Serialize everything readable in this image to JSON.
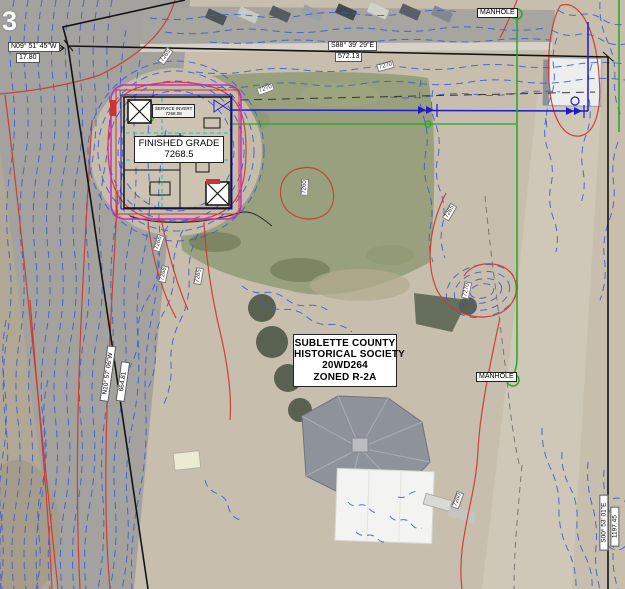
{
  "pavement_marking": "3",
  "survey": {
    "nw_bearing": "N09° 51' 45\"W",
    "nw_distance": "17.80",
    "north_bearing": "S88° 39' 29\"E",
    "north_distance": "572.13",
    "west_bearing": "N10° 57' 06\"W",
    "west_distance": "664.81",
    "east_bearing": "S00° 53' 01\"E",
    "east_distance": "1197.45"
  },
  "labels": {
    "manhole_top": "MANHOLE",
    "manhole_east": "MANHOLE",
    "finished_grade": {
      "line1": "FINISHED GRADE",
      "line2": "7268.5"
    },
    "service_invert": {
      "line1": "SERVICE INVERT",
      "line2": "7268.08"
    },
    "parcel": {
      "line1": "SUBLETTE COUNTY",
      "line2": "HISTORICAL SOCIETY",
      "line3": "20WD264",
      "line4": "ZONED R-2A"
    }
  },
  "contour_labels": [
    {
      "text": "7265",
      "x": 168,
      "y": 56,
      "rot": -55
    },
    {
      "text": "7270",
      "x": 268,
      "y": 89,
      "rot": -20
    },
    {
      "text": "7270",
      "x": 388,
      "y": 66,
      "rot": -15
    },
    {
      "text": "7266",
      "x": 161,
      "y": 243,
      "rot": -72
    },
    {
      "text": "7268",
      "x": 166,
      "y": 274,
      "rot": -78
    },
    {
      "text": "7265",
      "x": 201,
      "y": 276,
      "rot": -80
    },
    {
      "text": "7260",
      "x": 307,
      "y": 187,
      "rot": -87
    },
    {
      "text": "7265",
      "x": 452,
      "y": 212,
      "rot": -60
    },
    {
      "text": "7270",
      "x": 469,
      "y": 290,
      "rot": -78
    },
    {
      "text": "7260",
      "x": 460,
      "y": 500,
      "rot": -70
    }
  ],
  "colors": {
    "contour_minor": "#3b5fd0",
    "contour_major": "#cc3b33",
    "boundary": "#141414",
    "proposed_outline": "#c829c8",
    "water_line": "#1c1ccc",
    "sewer_line": "#27a527",
    "label_bg": "#ffffff"
  }
}
